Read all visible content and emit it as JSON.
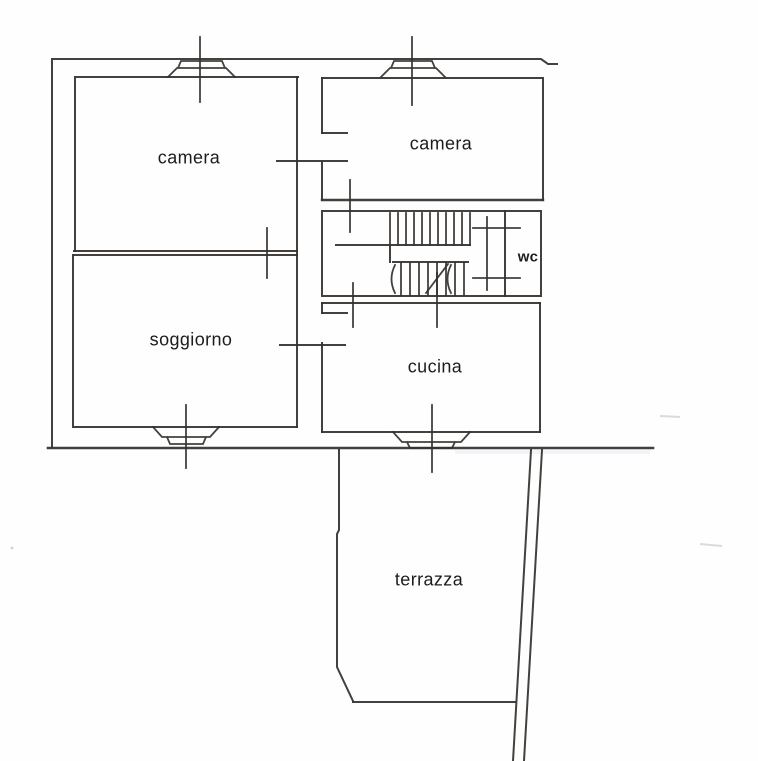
{
  "document": {
    "kind": "scanned apartment floor plan",
    "background_color": "#fefefe",
    "wall_line_color": "#35322e",
    "label_color": "#1c1c1c"
  },
  "rooms": [
    {
      "id": "camera-1",
      "label": "camera"
    },
    {
      "id": "camera-2",
      "label": "camera"
    },
    {
      "id": "soggiorno",
      "label": "soggiorno"
    },
    {
      "id": "cucina",
      "label": "cucina"
    },
    {
      "id": "wc",
      "label": "wc"
    },
    {
      "id": "terrazza",
      "label": "terrazza"
    }
  ]
}
